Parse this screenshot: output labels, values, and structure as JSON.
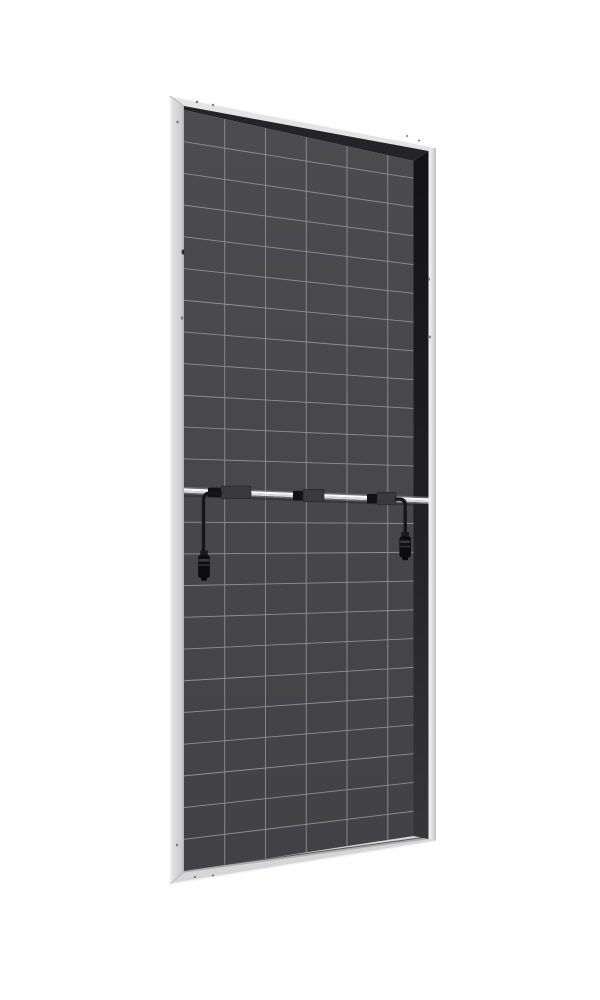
{
  "meta": {
    "subject": "bifacial-solar-panel-rear-view",
    "background": "#ffffff",
    "canvas": {
      "width": 600,
      "height": 1000
    }
  },
  "panel": {
    "outer_quad": [
      [
        170,
        96
      ],
      [
        436,
        147.5
      ],
      [
        436,
        841
      ],
      [
        170,
        884
      ]
    ],
    "frame": {
      "base_color": "#d7d7d9",
      "left_face": {
        "outer_x": 170,
        "inner_x": 184,
        "top_outer_y": 96,
        "top_inner_y": 106,
        "bottom_outer_y": 884,
        "bottom_inner_y": 872,
        "grad": [
          [
            "0",
            "#f4f4f6"
          ],
          [
            "0.22",
            "#dedee0"
          ],
          [
            "0.6",
            "#d3d3d5"
          ],
          [
            "1",
            "#c3c3c5"
          ]
        ],
        "seam_color": "#9a9a9d"
      },
      "top_face": {
        "outer": [
          [
            170,
            96
          ],
          [
            436,
            147.5
          ]
        ],
        "inner": [
          [
            184,
            106
          ],
          [
            428.5,
            151
          ]
        ],
        "color": "#e4e4e6",
        "highlight": "#fbfbfd"
      },
      "right_strip": {
        "inner_x": 428.5,
        "outer_x": 436,
        "inner_top_y": 151,
        "inner_bottom_y": 839,
        "outer_top_y": 147.5,
        "outer_bottom_y": 841,
        "grad": [
          [
            "0",
            "#bfbfc1"
          ],
          [
            "0.65",
            "#e7e7e9"
          ],
          [
            "1",
            "#f2f2f4"
          ]
        ]
      },
      "bottom_face": {
        "inner": [
          [
            184,
            872
          ],
          [
            428.5,
            838.5
          ]
        ],
        "outer": [
          [
            170,
            884
          ],
          [
            436,
            841
          ]
        ],
        "color": "#d6d6d8",
        "highlight": "#f2f2f4",
        "lip_color": "#acacae",
        "seam_color": "#59595c"
      },
      "top_shadow": {
        "pts": [
          [
            184,
            106
          ],
          [
            428.5,
            151
          ],
          [
            413.5,
            161
          ],
          [
            184,
            110
          ]
        ],
        "color": "#242428"
      },
      "inner_wall": {
        "pts": [
          [
            413.5,
            161
          ],
          [
            428.5,
            151
          ],
          [
            428.5,
            839
          ],
          [
            413.5,
            836
          ]
        ],
        "grad": [
          [
            "0",
            "#131316"
          ],
          [
            "0.5",
            "#202024"
          ],
          [
            "1",
            "#37373b"
          ]
        ]
      },
      "miter_color": "#b2b2b4",
      "holes_color": "#77777a",
      "holes": [
        {
          "x": 197,
          "y": 102,
          "rx": 1.2,
          "ry": 1.2
        },
        {
          "x": 213,
          "y": 105,
          "rx": 1.2,
          "ry": 1.2
        },
        {
          "x": 407,
          "y": 136,
          "rx": 1.0,
          "ry": 1.0
        },
        {
          "x": 419,
          "y": 140.5,
          "rx": 1.0,
          "ry": 1.0
        },
        {
          "x": 177.5,
          "y": 122,
          "rx": 1.1,
          "ry": 1.4
        },
        {
          "x": 183,
          "y": 252,
          "rx": 1.4,
          "ry": 2.6,
          "color": "#2c2c2f"
        },
        {
          "x": 182,
          "y": 318,
          "rx": 1.1,
          "ry": 1.7
        },
        {
          "x": 177,
          "y": 845,
          "rx": 1.1,
          "ry": 1.4
        },
        {
          "x": 429,
          "y": 279,
          "rx": 1.0,
          "ry": 1.5
        },
        {
          "x": 430,
          "y": 337,
          "rx": 1.0,
          "ry": 1.5
        },
        {
          "x": 195,
          "y": 877,
          "rx": 1.3,
          "ry": 1.0
        },
        {
          "x": 213,
          "y": 875.5,
          "rx": 1.3,
          "ry": 1.0
        }
      ]
    },
    "cells": {
      "rows": 24,
      "cols": 6,
      "quad": [
        [
          184,
          110
        ],
        [
          413.5,
          161
        ],
        [
          413.5,
          836
        ],
        [
          184,
          871
        ]
      ],
      "hidden_right_edge": {
        "x": 428.5,
        "top_y": 152,
        "bottom_y": 838
      },
      "left_edge": {
        "x": 184,
        "top_y": 110,
        "bottom_y": 871
      },
      "grad": [
        [
          "0",
          "#4c4c50"
        ],
        [
          "0.55",
          "#474749"
        ],
        [
          "1",
          "#424246"
        ]
      ],
      "grid_color": "#909093",
      "grid_width": 0.9
    },
    "rail": {
      "x0": 184,
      "x1": 428.5,
      "mid_y0": 490.5,
      "mid_y1": 500.5,
      "height": 7.2,
      "strips": [
        [
          "#6f6f72",
          0.2
        ],
        [
          "#fbfbfd",
          0.32
        ],
        [
          "#d9d9db",
          0.3
        ],
        [
          "#68686b",
          0.18
        ]
      ],
      "shadow_color": "#2b2b2e"
    },
    "junction_boxes": [
      {
        "x0": 221,
        "x1": 251,
        "clip_x0": 208,
        "clip_x1": 221
      },
      {
        "x0": 303,
        "x1": 324,
        "clip_x0": 293,
        "clip_x1": 303
      },
      {
        "x0": 377,
        "x1": 396,
        "clip_x0": 367,
        "clip_x1": 377
      }
    ],
    "box_style": {
      "fill": "#3a3a3d",
      "stroke": "#232326",
      "h": 12.5,
      "clip_fill": "#121215",
      "clip_h": 9.5
    },
    "cables": {
      "color": "#17171a",
      "width": 3.4,
      "left": {
        "attach_x": 222,
        "bend_x": 203.5,
        "drop_y": 556
      },
      "right": {
        "attach_x": 395,
        "bend_x": 405.2,
        "drop_y": 538
      },
      "connector_left": {
        "x": 198.2,
        "y": 555,
        "w": 11.6,
        "h": 23
      },
      "connector_right": {
        "x": 399.4,
        "y": 536.5,
        "w": 11.6,
        "h": 21
      },
      "connector_style": {
        "body": "#0d0d0f",
        "ferrule": "#1b1b1e",
        "ridge1": "#3a3a3e",
        "ridge2": "#2b2b2f",
        "tip": "#0a0a0c"
      }
    }
  }
}
